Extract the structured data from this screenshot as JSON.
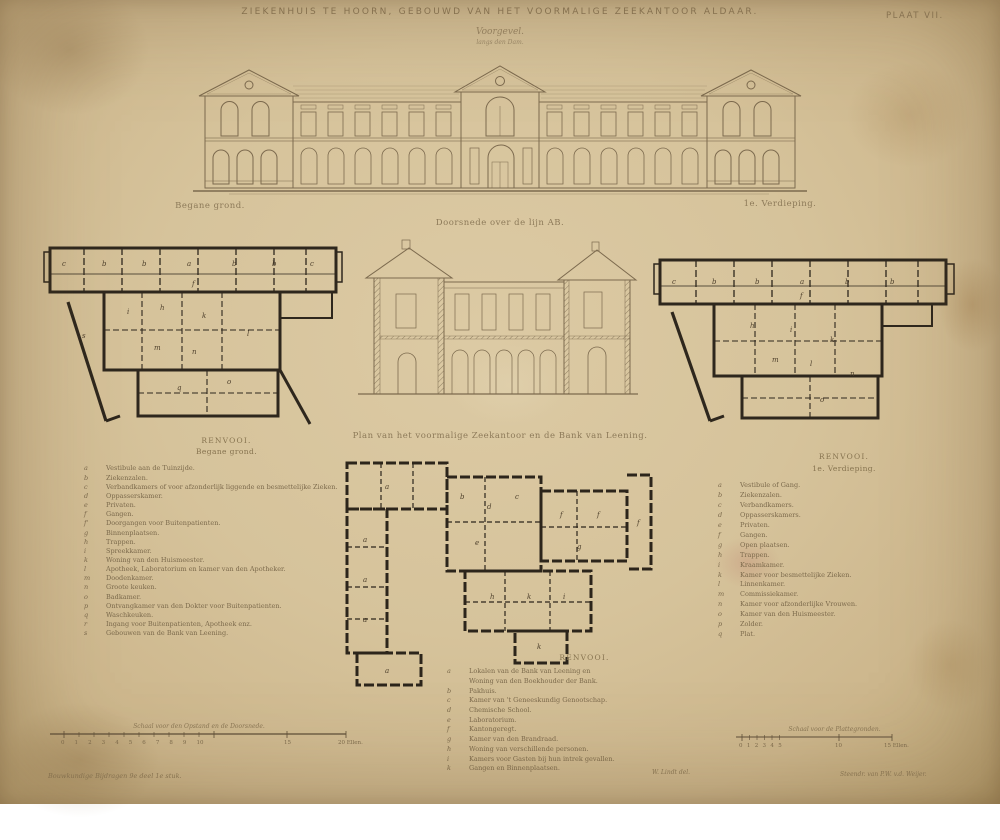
{
  "plate": {
    "title": "ZIEKENHUIS TE HOORN, GEBOUWD VAN HET VOORMALIGE ZEEKANTOOR ALDAAR.",
    "number": "PLAAT VII.",
    "subtitle": "Voorgevel.",
    "subtitle2": "langs den Dam."
  },
  "drawings": {
    "ground_plan": {
      "label": "Begane grond.",
      "letters": [
        {
          "t": "c",
          "x": 20,
          "y": 48
        },
        {
          "t": "b",
          "x": 60,
          "y": 48
        },
        {
          "t": "b",
          "x": 100,
          "y": 48
        },
        {
          "t": "a",
          "x": 145,
          "y": 48
        },
        {
          "t": "b",
          "x": 190,
          "y": 48
        },
        {
          "t": "b",
          "x": 230,
          "y": 48
        },
        {
          "t": "c",
          "x": 268,
          "y": 48
        },
        {
          "t": "f",
          "x": 150,
          "y": 68
        },
        {
          "t": "i",
          "x": 85,
          "y": 96
        },
        {
          "t": "h",
          "x": 118,
          "y": 92
        },
        {
          "t": "k",
          "x": 160,
          "y": 100
        },
        {
          "t": "l",
          "x": 205,
          "y": 118
        },
        {
          "t": "n",
          "x": 150,
          "y": 136
        },
        {
          "t": "m",
          "x": 112,
          "y": 132
        },
        {
          "t": "q",
          "x": 135,
          "y": 172
        },
        {
          "t": "o",
          "x": 185,
          "y": 166
        },
        {
          "t": "s",
          "x": 40,
          "y": 120
        }
      ]
    },
    "section": {
      "label": "Doorsnede over de lijn AB."
    },
    "first_floor": {
      "label": "1e. Verdieping.",
      "letters": [
        {
          "t": "c",
          "x": 22,
          "y": 38
        },
        {
          "t": "b",
          "x": 62,
          "y": 38
        },
        {
          "t": "b",
          "x": 105,
          "y": 38
        },
        {
          "t": "a",
          "x": 150,
          "y": 38
        },
        {
          "t": "b",
          "x": 195,
          "y": 38
        },
        {
          "t": "b",
          "x": 240,
          "y": 38
        },
        {
          "t": "f",
          "x": 150,
          "y": 52
        },
        {
          "t": "h",
          "x": 100,
          "y": 82
        },
        {
          "t": "i",
          "x": 140,
          "y": 86
        },
        {
          "t": "k",
          "x": 180,
          "y": 96
        },
        {
          "t": "l",
          "x": 160,
          "y": 120
        },
        {
          "t": "m",
          "x": 122,
          "y": 116
        },
        {
          "t": "n",
          "x": 200,
          "y": 130
        },
        {
          "t": "o",
          "x": 170,
          "y": 156
        }
      ]
    },
    "site_plan": {
      "label": "Plan van het voormalige Zeekantoor en de Bank van Leening.",
      "letters": [
        {
          "t": "a",
          "x": 60,
          "y": 42
        },
        {
          "t": "a",
          "x": 38,
          "y": 95
        },
        {
          "t": "a",
          "x": 38,
          "y": 135
        },
        {
          "t": "a",
          "x": 38,
          "y": 175
        },
        {
          "t": "a",
          "x": 60,
          "y": 226
        },
        {
          "t": "b",
          "x": 135,
          "y": 52
        },
        {
          "t": "d",
          "x": 162,
          "y": 62
        },
        {
          "t": "c",
          "x": 190,
          "y": 52
        },
        {
          "t": "e",
          "x": 150,
          "y": 98
        },
        {
          "t": "f",
          "x": 235,
          "y": 70
        },
        {
          "t": "f",
          "x": 272,
          "y": 70
        },
        {
          "t": "f",
          "x": 312,
          "y": 78
        },
        {
          "t": "g",
          "x": 252,
          "y": 102
        },
        {
          "t": "h",
          "x": 165,
          "y": 152
        },
        {
          "t": "k",
          "x": 202,
          "y": 152
        },
        {
          "t": "i",
          "x": 238,
          "y": 152
        },
        {
          "t": "k",
          "x": 212,
          "y": 202
        }
      ]
    }
  },
  "legend_left": {
    "title": "RENVOOI.",
    "subtitle": "Begane grond.",
    "items": [
      {
        "k": "a",
        "t": "Vestibule aan de Tuinzijde."
      },
      {
        "k": "b",
        "t": "Ziekenzalen."
      },
      {
        "k": "c",
        "t": "Verbandkamers of voor afzonderlijk liggende en besmettelijke Zieken."
      },
      {
        "k": "d",
        "t": "Oppasserskamer."
      },
      {
        "k": "e",
        "t": "Privaten."
      },
      {
        "k": "f",
        "t": "Gangen."
      },
      {
        "k": "f'",
        "t": "Doorgangen voor Buitenpatienten."
      },
      {
        "k": "g",
        "t": "Binnenplaatsen."
      },
      {
        "k": "h",
        "t": "Trappen."
      },
      {
        "k": "i",
        "t": "Spreekkamer."
      },
      {
        "k": "k",
        "t": "Woning van den Huismeester."
      },
      {
        "k": "l",
        "t": "Apotheek, Laboratorium en kamer van den Apotheker."
      },
      {
        "k": "m",
        "t": "Doodenkamer."
      },
      {
        "k": "n",
        "t": "Groote keuken."
      },
      {
        "k": "o",
        "t": "Badkamer."
      },
      {
        "k": "p",
        "t": "Ontvangkamer van den Dokter voor Buitenpatienten."
      },
      {
        "k": "q",
        "t": "Waschkeuken."
      },
      {
        "k": "r",
        "t": "Ingang voor Buitenpatienten, Apotheek enz."
      },
      {
        "k": "s",
        "t": "Gebouwen van de Bank van Leening."
      }
    ]
  },
  "legend_right": {
    "title": "RENVOOI.",
    "subtitle": "1e. Verdieping.",
    "items": [
      {
        "k": "a",
        "t": "Vestibule of Gang."
      },
      {
        "k": "b",
        "t": "Ziekenzalen."
      },
      {
        "k": "c",
        "t": "Verbandkamers."
      },
      {
        "k": "d",
        "t": "Oppasserskamers."
      },
      {
        "k": "e",
        "t": "Privaten."
      },
      {
        "k": "f",
        "t": "Gangen."
      },
      {
        "k": "g",
        "t": "Open plaatsen."
      },
      {
        "k": "h",
        "t": "Trappen."
      },
      {
        "k": "i",
        "t": "Kraamkamer."
      },
      {
        "k": "k",
        "t": "Kamer voor besmettelijke Zieken."
      },
      {
        "k": "l",
        "t": "Linnenkamer."
      },
      {
        "k": "m",
        "t": "Commissiekamer."
      },
      {
        "k": "n",
        "t": "Kamer voor afzonderlijke Vrouwen."
      },
      {
        "k": "o",
        "t": "Kamer van den Huismeester."
      },
      {
        "k": "p",
        "t": "Zolder."
      },
      {
        "k": "q",
        "t": "Plat."
      }
    ]
  },
  "legend_bottom": {
    "title": "RENVOOI.",
    "items": [
      {
        "k": "a",
        "t": "Lokalen van de Bank van Leening en"
      },
      {
        "k": "",
        "t": "Woning van den Boekhouder der Bank."
      },
      {
        "k": "b",
        "t": "Pakhuis."
      },
      {
        "k": "c",
        "t": "Kamer van 't Geneeskundig Genootschap."
      },
      {
        "k": "d",
        "t": "Chemische School."
      },
      {
        "k": "e",
        "t": "Laboratorium."
      },
      {
        "k": "f",
        "t": "Kantongeregt."
      },
      {
        "k": "g",
        "t": "Kamer van den Brandraad."
      },
      {
        "k": "h",
        "t": "Woning van verschillende personen."
      },
      {
        "k": "i",
        "t": "Kamers voor Gasten bij hun intrek gevallen."
      },
      {
        "k": "k",
        "t": "Gangen en Binnenplaatsen."
      }
    ]
  },
  "scale_left": {
    "caption": "Schaal voor den Opstand en de Doorsnede.",
    "numbers": "0 1 2 3 4 5 6 7 8 9 10",
    "mid": "15",
    "end": "20 Ellen."
  },
  "scale_right": {
    "caption": "Schaal voor de Plattegronden.",
    "numbers": "0 1 2 3 4 5",
    "mid": "10",
    "end": "15 Ellen."
  },
  "credits": {
    "left": "Bouwkundige Bijdragen 9e deel 1e stuk.",
    "center": "W. Lindt del.",
    "right": "Steendr. van P.W. v.d. Weijer."
  }
}
